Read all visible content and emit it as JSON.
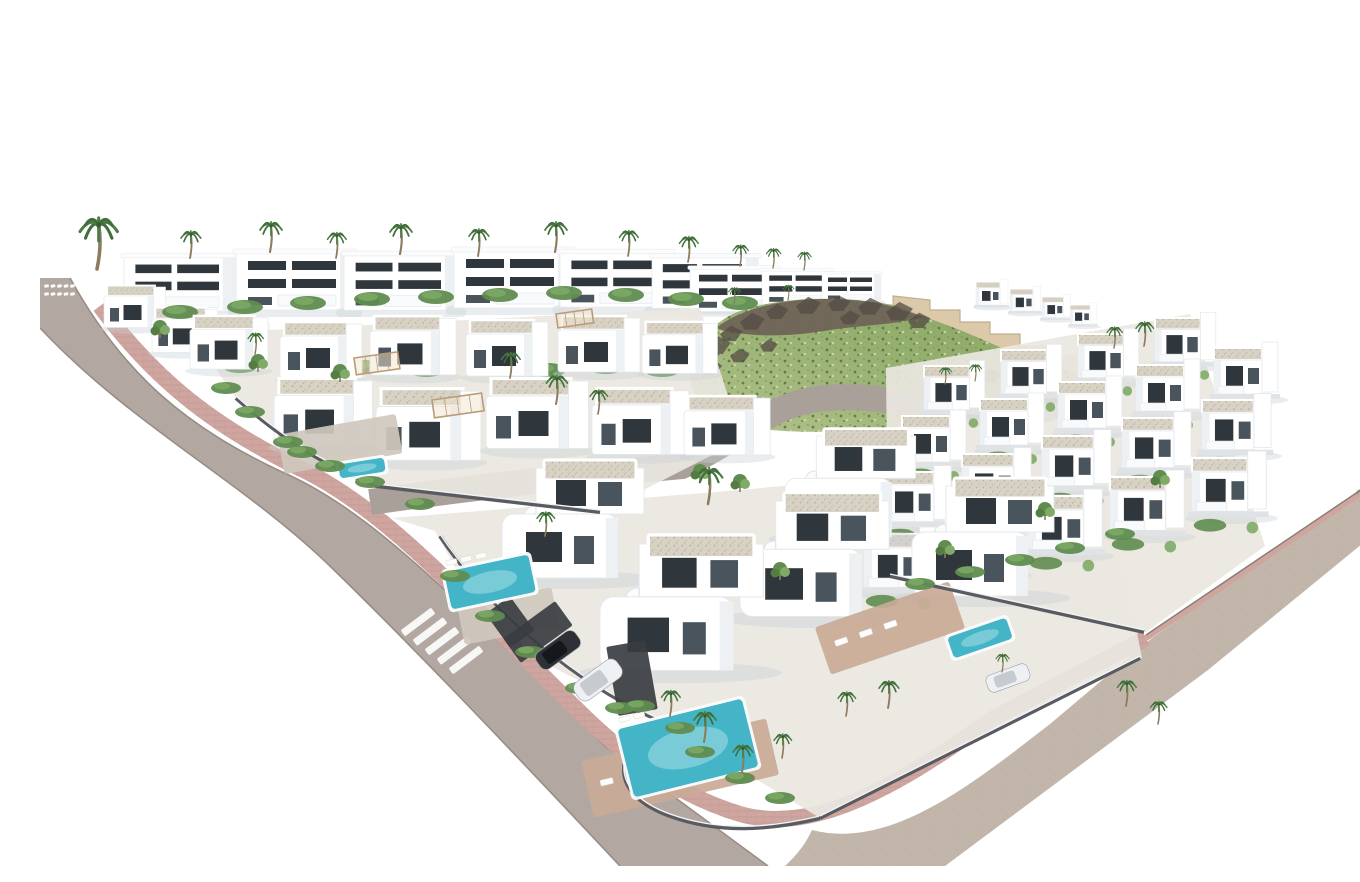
{
  "image": {
    "subject": "Aerial 3D architectural rendering of a modern white villa resort development with private pools, palm trees, curved streets, pink paver sidewalks and a green rocky hillside",
    "style": "photoreal CGI masterplan render on white background"
  },
  "palette": {
    "bg": "#ffffff",
    "road": "#b3a8a1",
    "roadInner": "#a9a099",
    "roadEdge": "#978d85",
    "sidewalk": "#cfa5a0",
    "paver": "#b98e89",
    "curb": "#8a8076",
    "verge": "#c2b6aa",
    "hillGreen": "#96b070",
    "hillLight": "#b7c693",
    "rock": "#6f6459",
    "rockDark": "#544c44",
    "wall": "#dcc9a9",
    "wallEdge": "#bfae92",
    "white": "#ffffff",
    "edge": "#e4e8ec",
    "side": "#edf1f4",
    "win": "#2f363c",
    "win2": "#4a545d",
    "balc": "#f8fafb",
    "shadow": "#cbd1d6",
    "lot": "#eae7e1",
    "lotAlt": "#cfc8bd",
    "green": "#5f8c4f",
    "greenLight": "#7fab67",
    "trunk": "#8d7b5e",
    "frond": "#4c7c44",
    "pool": "#43b5c6",
    "poolLight": "#8ad3dc",
    "patio": "#c9aa96",
    "fence": "#5a5b60",
    "fenceLight": "#f1f4f6",
    "pergola": "#ba9c78",
    "carDark": "#2d3135",
    "carWhite": "#eef0f3"
  },
  "scene": {
    "road_main_d": "M30,262 C85,362 150,412 240,455 C340,498 430,600 565,730 L728,850 L580,850 C460,722 372,630 292,552 C204,466 92,410 0,312 L0,262 Z",
    "road_edge_ne_d": "M30,262 C85,362 150,412 240,455 C340,498 430,600 565,730 L728,850",
    "road_edge_sw_d": "M0,312 C92,410 204,466 292,552 C372,630 460,722 580,850",
    "road_inner_d": "M330,486 C430,472 530,460 642,450 C702,422 718,398 762,386 C820,372 878,392 948,398 C1000,402 1028,386 1056,372",
    "sidewalk_d": "M60,290 C115,365 175,410 255,450 C348,492 428,588 548,704 C588,742 640,780 700,798 C770,818 850,776 950,704 L1106,622",
    "curb_d": "M1106,622 L1334,468",
    "verge_d": "M772,814 C850,834 930,770 1010,708 L1112,622 L1336,466 L1344,510 L1168,654 L905,850 L745,850 C758,838 766,827 772,814 Z",
    "crosswalk": {
      "x": 378,
      "y": 606,
      "n": 5,
      "dx": 12,
      "dy": 9.5,
      "w": 38,
      "h": 7.5,
      "rot": -37
    },
    "minidash": {
      "x": 4,
      "y": 269,
      "n": 5,
      "dx": 6.5,
      "rows": 2,
      "rowdy": 8,
      "w": 4.5,
      "h": 3,
      "rot": -12
    },
    "hill": {
      "wall_d": "M853,280 L890,284 L890,294 L920,294 L920,306 L950,306 L950,318 L980,318 L980,330 L1010,330 L1010,340 L1038,340 L1038,350 L1062,350 L1062,362 L1010,378 L950,394 L888,402 L856,380 Z",
      "green_d": "M650,356 C654,326 674,305 700,295 C740,281 800,279 853,289 L920,314 L990,344 L1044,360 C1004,386 952,398 892,406 C822,416 756,420 702,410 C668,402 648,382 650,356 Z",
      "ridge_d": "M676,312 C696,296 728,287 760,284 C800,281 832,285 854,291 L884,301 C854,309 822,309 790,314 C750,321 706,322 676,312 Z",
      "rocks": [
        [
          664,
          330,
          1.2
        ],
        [
          680,
          318,
          1
        ],
        [
          700,
          306,
          1.1
        ],
        [
          726,
          296,
          1
        ],
        [
          756,
          290,
          1.1
        ],
        [
          788,
          288,
          1
        ],
        [
          818,
          291,
          1.1
        ],
        [
          846,
          296,
          1.2
        ],
        [
          868,
          305,
          1
        ],
        [
          690,
          340,
          0.9
        ],
        [
          720,
          330,
          0.8
        ],
        [
          800,
          302,
          0.9
        ],
        [
          660,
          352,
          1
        ],
        [
          940,
          360,
          0.9
        ],
        [
          966,
          370,
          0.8
        ],
        [
          996,
          376,
          0.9
        ]
      ]
    },
    "grounds": [
      "152,318 660,292 702,424 560,496 336,470 262,436 196,382",
      "352,502 700,474 1062,440 1102,642 780,802 622,706 500,645 420,560 395,515",
      "846,352 1150,298 1225,530 1106,616 848,560"
    ],
    "villas_back": [
      {
        "t": "back",
        "x": 84,
        "y": 240,
        "s": 0.95
      },
      {
        "t": "back",
        "x": 196,
        "y": 236,
        "s": 1.0
      },
      {
        "t": "back",
        "x": 304,
        "y": 238,
        "s": 0.97
      },
      {
        "t": "back",
        "x": 414,
        "y": 234,
        "s": 1.0
      },
      {
        "t": "back",
        "x": 520,
        "y": 236,
        "s": 0.95
      },
      {
        "t": "back",
        "x": 612,
        "y": 240,
        "s": 0.9
      },
      {
        "t": "back",
        "x": 650,
        "y": 252,
        "s": 0.75
      },
      {
        "t": "back",
        "x": 722,
        "y": 254,
        "s": 0.6
      },
      {
        "t": "back",
        "x": 782,
        "y": 257,
        "s": 0.5
      },
      {
        "t": "cube",
        "x": 64,
        "y": 268,
        "s": 0.75
      },
      {
        "t": "cube",
        "x": 112,
        "y": 290,
        "s": 0.8
      },
      {
        "t": "cube",
        "x": 168,
        "y": 304,
        "s": 0.75
      },
      {
        "t": "right",
        "x": 936,
        "y": 266,
        "s": 0.5
      },
      {
        "t": "right",
        "x": 970,
        "y": 273,
        "s": 0.48
      },
      {
        "t": "right",
        "x": 1002,
        "y": 281,
        "s": 0.45
      },
      {
        "t": "right",
        "x": 1030,
        "y": 289,
        "s": 0.42
      }
    ],
    "hedgerows": [
      [
        [
          140,
          296
        ],
        [
          205,
          291
        ],
        [
          268,
          287
        ],
        [
          332,
          283
        ],
        [
          396,
          281
        ],
        [
          460,
          279
        ],
        [
          524,
          277
        ],
        [
          586,
          279
        ],
        [
          646,
          283
        ],
        [
          700,
          287
        ]
      ],
      [
        [
          200,
          350
        ],
        [
          262,
          354
        ],
        [
          324,
          351
        ],
        [
          386,
          354
        ],
        [
          448,
          351
        ],
        [
          508,
          354
        ],
        [
          566,
          351
        ],
        [
          622,
          354
        ]
      ]
    ],
    "villas_mid": [
      {
        "t": "cube",
        "x": 150,
        "y": 298,
        "s": 0.95
      },
      {
        "t": "cube",
        "x": 240,
        "y": 304,
        "s": 1.0
      },
      {
        "t": "cube",
        "x": 330,
        "y": 298,
        "s": 1.05
      },
      {
        "t": "cube",
        "x": 426,
        "y": 302,
        "s": 1.0
      },
      {
        "t": "cube",
        "x": 518,
        "y": 298,
        "s": 1.0
      },
      {
        "t": "cube",
        "x": 602,
        "y": 304,
        "s": 0.92
      },
      {
        "t": "cube",
        "x": 234,
        "y": 360,
        "s": 1.2
      },
      {
        "t": "cube",
        "x": 336,
        "y": 370,
        "s": 1.28
      },
      {
        "t": "cube",
        "x": 446,
        "y": 360,
        "s": 1.25
      },
      {
        "t": "cube",
        "x": 552,
        "y": 370,
        "s": 1.18
      },
      {
        "t": "cube",
        "x": 644,
        "y": 378,
        "s": 1.05
      }
    ],
    "rows": [
      {
        "x": 884,
        "y": 350,
        "dx": 77,
        "dy": -16,
        "n": 4,
        "s": 0.95
      },
      {
        "x": 862,
        "y": 400,
        "dx": 78,
        "dy": -17,
        "n": 5,
        "s": 1.0
      },
      {
        "x": 842,
        "y": 456,
        "dx": 80,
        "dy": -18,
        "n": 5,
        "s": 1.08
      },
      {
        "x": 824,
        "y": 518,
        "dx": 82,
        "dy": -19,
        "n": 5,
        "s": 1.16
      }
    ],
    "villas_front": [
      {
        "t": "front",
        "x": 745,
        "y": 420,
        "s": 0.92
      },
      {
        "t": "front",
        "x": 872,
        "y": 470,
        "s": 1.0
      },
      {
        "t": "front",
        "x": 462,
        "y": 452,
        "s": 1.0
      },
      {
        "t": "front",
        "x": 700,
        "y": 485,
        "s": 1.05
      },
      {
        "t": "front",
        "x": 560,
        "y": 528,
        "s": 1.15
      }
    ],
    "patios": [
      [
        640,
        752,
        190,
        58,
        -13,
        0
      ],
      [
        850,
        612,
        142,
        50,
        -19,
        0
      ],
      [
        300,
        428,
        120,
        40,
        -10,
        1
      ],
      [
        468,
        600,
        96,
        40,
        -11,
        1
      ]
    ],
    "pergolas": [
      [
        314,
        342,
        44,
        17,
        -8
      ],
      [
        392,
        384,
        50,
        18,
        -8
      ],
      [
        516,
        298,
        36,
        14,
        -8
      ]
    ],
    "fences": [
      "M196,382 C250,430 292,452 336,470 L560,496",
      "M400,520 C440,580 520,660 622,706",
      "M622,706 C570,736 570,778 630,800 C680,818 730,814 780,802",
      "M780,802 L1100,642",
      "M850,560 L1104,616"
    ],
    "darkrects": [
      [
        498,
        616,
        64,
        30,
        -36
      ],
      [
        470,
        606,
        30,
        42,
        -36
      ],
      [
        592,
        662,
        40,
        70,
        -10
      ]
    ],
    "pools": [
      [
        322,
        452,
        46,
        14,
        -9,
        0
      ],
      [
        450,
        566,
        86,
        38,
        -12,
        3
      ],
      [
        648,
        732,
        128,
        70,
        -14,
        2
      ],
      [
        940,
        622,
        62,
        22,
        -19,
        0
      ]
    ],
    "hedges": [
      [
        210,
        396
      ],
      [
        248,
        426
      ],
      [
        290,
        450
      ],
      [
        330,
        466
      ],
      [
        380,
        488
      ],
      [
        262,
        436
      ],
      [
        186,
        372
      ],
      [
        415,
        560
      ],
      [
        450,
        600
      ],
      [
        490,
        636
      ],
      [
        540,
        672
      ],
      [
        580,
        692
      ],
      [
        640,
        712
      ],
      [
        600,
        690
      ],
      [
        660,
        736
      ],
      [
        700,
        762
      ],
      [
        740,
        782
      ],
      [
        880,
        568
      ],
      [
        930,
        556
      ],
      [
        980,
        544
      ],
      [
        1030,
        532
      ],
      [
        1080,
        518
      ]
    ],
    "trees": [
      [
        120,
        318
      ],
      [
        218,
        352
      ],
      [
        300,
        362
      ],
      [
        660,
        462
      ],
      [
        700,
        472
      ],
      [
        905,
        538
      ],
      [
        1005,
        500
      ],
      [
        1120,
        468
      ],
      [
        740,
        560
      ]
    ],
    "cars": [
      [
        518,
        634,
        48,
        20,
        -36,
        "dark"
      ],
      [
        558,
        664,
        52,
        22,
        -36,
        "white"
      ],
      [
        968,
        662,
        44,
        18,
        -20,
        "white"
      ]
    ],
    "palms": [
      [
        57,
        253,
        1.7
      ],
      [
        150,
        242,
        0.9
      ],
      [
        230,
        236,
        1.0
      ],
      [
        296,
        242,
        0.85
      ],
      [
        360,
        238,
        1.0
      ],
      [
        438,
        240,
        0.9
      ],
      [
        515,
        236,
        1.0
      ],
      [
        588,
        240,
        0.85
      ],
      [
        648,
        246,
        0.85
      ],
      [
        700,
        250,
        0.7
      ],
      [
        733,
        252,
        0.65
      ],
      [
        764,
        254,
        0.6
      ],
      [
        215,
        338,
        0.7
      ],
      [
        470,
        362,
        0.85
      ],
      [
        516,
        388,
        0.95
      ],
      [
        558,
        398,
        0.8
      ],
      [
        905,
        368,
        0.55
      ],
      [
        935,
        365,
        0.55
      ],
      [
        1074,
        332,
        0.7
      ],
      [
        1104,
        330,
        0.8
      ],
      [
        668,
        488,
        1.2
      ],
      [
        505,
        520,
        0.8
      ],
      [
        630,
        700,
        0.85
      ],
      [
        664,
        726,
        1.0
      ],
      [
        702,
        756,
        0.9
      ],
      [
        742,
        742,
        0.8
      ],
      [
        806,
        700,
        0.8
      ],
      [
        848,
        692,
        0.9
      ],
      [
        1086,
        690,
        0.85
      ],
      [
        1118,
        708,
        0.75
      ],
      [
        962,
        656,
        0.6
      ],
      [
        694,
        288,
        0.55
      ],
      [
        748,
        284,
        0.5
      ],
      [
        1320,
        486,
        0.42,
        0.35
      ],
      [
        1338,
        494,
        0.36,
        0.3
      ]
    ]
  }
}
